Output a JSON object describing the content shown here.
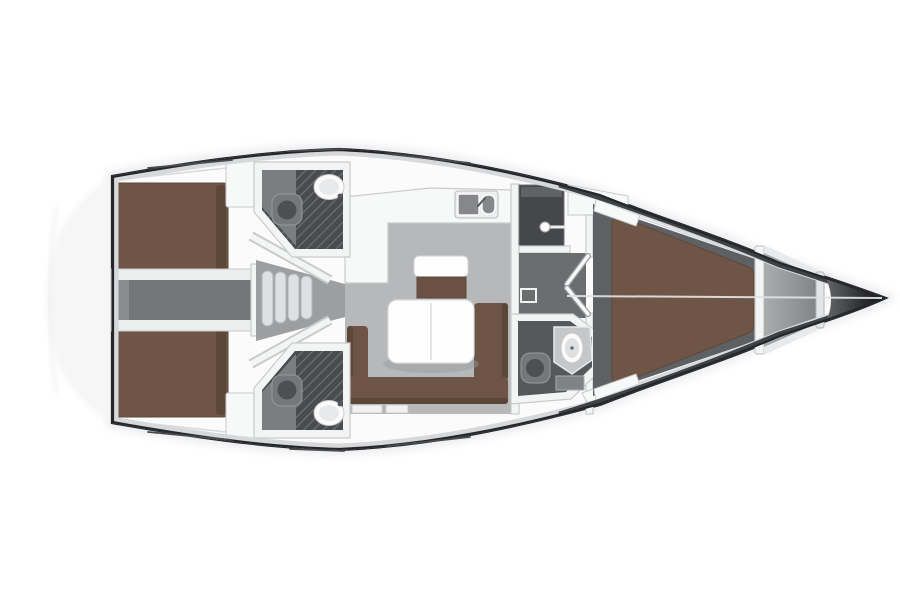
{
  "figure": {
    "type": "sailing-yacht-interior-floor-plan",
    "view": "top-down",
    "orientation": "bow-right",
    "label": "yacht-floor-plan",
    "visible_text_on_image": ""
  },
  "regions": [
    "transom-swim-platform",
    "aft-cabin-port",
    "aft-cabin-starboard",
    "engine-compartment-passage",
    "companionway-stairs",
    "head-port",
    "head-starboard",
    "salon",
    "galley",
    "nav-seat",
    "salon-table",
    "u-sofa",
    "midship-corridor",
    "wardrobe",
    "forward-head",
    "forward-cabin-v-berth",
    "anchor-locker",
    "bow"
  ],
  "colors": {
    "hull_outline": "#24262a",
    "deck_shade": "#d7d8da",
    "bow_band": "#3f4145",
    "deck_white": "#fbfbfc",
    "transom_ghost": "#f6f6f7",
    "halo": "#e7e8ea",
    "bed_brown": "#6f5546",
    "bed_brown_dark": "#5d4739",
    "sofa_brown": "#6e5445",
    "sofa_brown_dark": "#5c4638",
    "bench_brown": "#6b5143",
    "table_white": "#fefefe",
    "salon_floor": "#b6b8ba",
    "funnel_floor": "#9c9ea0",
    "engine_floor": "#747678",
    "engine_surround": "#eceded",
    "corridor_floor": "#6b6d6f",
    "fwd_cabin_floor": "#5e6063",
    "head_floor": "#494b4e",
    "head_floor_light": "#7b7d80",
    "fwd_head_floor": "#56585b",
    "grate_line": "#6e7073",
    "wall_white": "#f3f4f4",
    "wall_edge": "#c9cacc",
    "fixture_dark": "#75777a",
    "fixture_darker": "#4d4f52",
    "porcelain": "#fafafa",
    "stairs_fill": "#dfe0e2",
    "stairs_edge": "#b2b3b5",
    "wardrobe_dark": "#45474a",
    "locker_light": "#aaacae",
    "locker_dark": "#7c7e80",
    "bow_grad_light": "#6c6e70",
    "bow_grad_dark": "#0b0b0c",
    "centerline": "#dfe0e3",
    "deck_line": "#d8d9db",
    "toe_mark": "#4a4c4f",
    "counter_white": "#f7f8f8",
    "sink_steel": "#85878a",
    "shadow": "#97999b"
  }
}
